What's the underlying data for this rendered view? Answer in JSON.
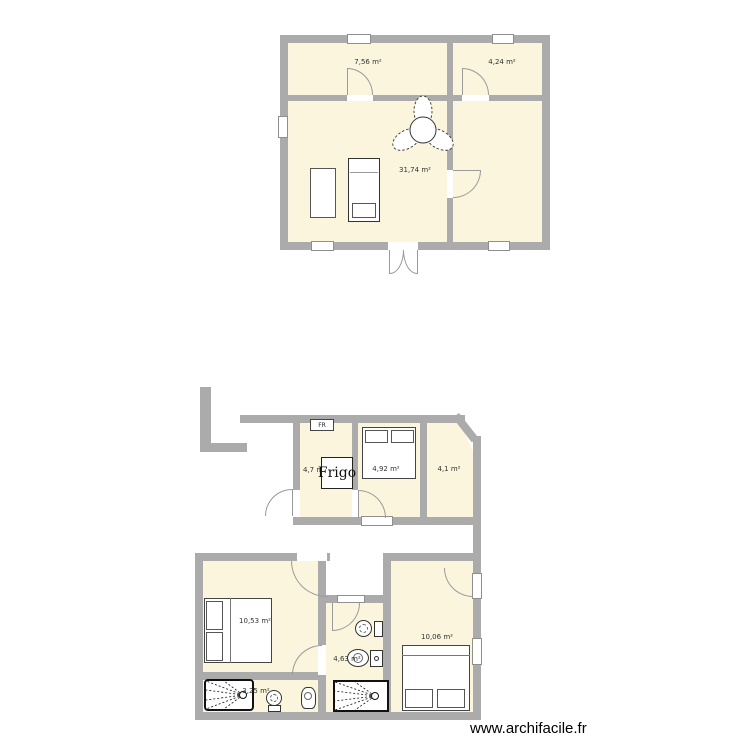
{
  "app": {
    "watermark": "www.archifacile.fr"
  },
  "colors": {
    "wall": "#ababab",
    "room_fill": "#faf5dc",
    "door_arc": "#9a9a9a",
    "label": "#333333"
  },
  "floor1": {
    "rooms": [
      {
        "id": "room-top-left",
        "label": "7,56 m²"
      },
      {
        "id": "room-top-right",
        "label": "4,24 m²"
      },
      {
        "id": "room-main",
        "label": "31,74 m²"
      }
    ]
  },
  "floor2": {
    "rooms": [
      {
        "id": "kitchen",
        "label": "4,7 m²"
      },
      {
        "id": "bedroom-small",
        "label": "4,92 m²"
      },
      {
        "id": "storage",
        "label": "4,1 m²"
      },
      {
        "id": "bedroom-left",
        "label": "10,53 m²"
      },
      {
        "id": "bathroom-middle",
        "label": "4,63 m²"
      },
      {
        "id": "bedroom-right",
        "label": "10,06 m²"
      },
      {
        "id": "bathroom-bottom",
        "label": "3,25 m²"
      }
    ],
    "fridge": {
      "label": "Frigo"
    },
    "appliance": {
      "label": "FR"
    }
  }
}
